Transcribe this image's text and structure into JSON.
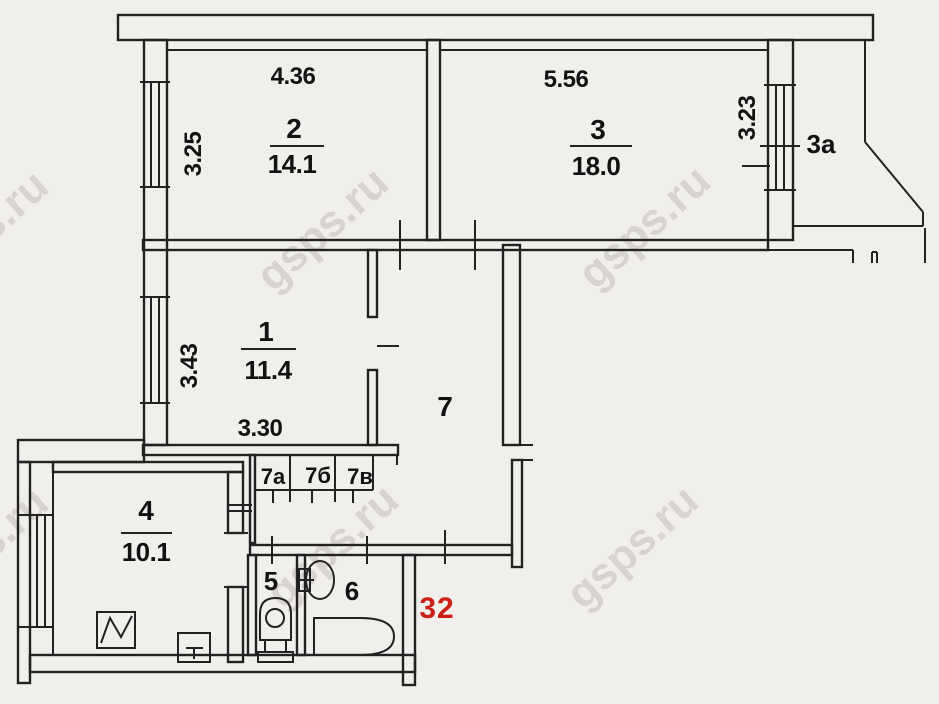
{
  "meta": {
    "apartment_number": "32"
  },
  "watermark": {
    "text": "gsps.ru",
    "color": "#c6c2bc"
  },
  "rooms": [
    {
      "number": "1",
      "area": "11.4",
      "width": "3.30",
      "depth": "3.43"
    },
    {
      "number": "2",
      "area": "14.1",
      "width": "4.36",
      "depth": "3.25"
    },
    {
      "number": "3",
      "area": "18.0",
      "width": "5.56",
      "depth": "3.23"
    },
    {
      "number": "3а"
    },
    {
      "number": "4",
      "area": "10.1"
    },
    {
      "number": "5"
    },
    {
      "number": "6"
    },
    {
      "number": "7"
    },
    {
      "number": "7а"
    },
    {
      "number": "7б"
    },
    {
      "number": "7в"
    }
  ],
  "colors": {
    "walls": "#222222",
    "text": "#121212",
    "apartment_number_red": "#cc1f16",
    "background": "#f1efec"
  }
}
